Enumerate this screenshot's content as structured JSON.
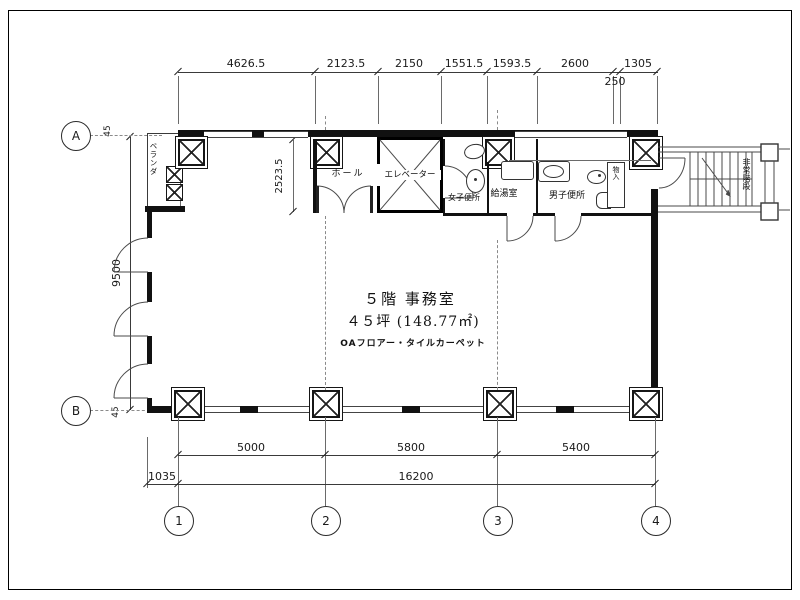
{
  "plan": {
    "office": {
      "title": "５階 事務室",
      "area": "４５坪 (148.77㎡)",
      "floor_spec": "OAフロアー・タイルカーペット"
    },
    "rooms": {
      "hall": "ホール",
      "elevator": "エレベーター",
      "womens_wc": "女子便所",
      "kitchen": "給湯室",
      "mens_wc": "男子便所",
      "storage": "物入",
      "veranda": "ベランダ",
      "stairs": "非常階段"
    }
  },
  "grid": {
    "a": "A",
    "b": "B",
    "c1": "1",
    "c2": "2",
    "c3": "3",
    "c4": "4"
  },
  "dims": {
    "top": [
      "4626.5",
      "2123.5",
      "2150",
      "1551.5",
      "1593.5",
      "2600",
      "1305"
    ],
    "top_sub": "250",
    "height": "9500",
    "hall_depth": "2523.5",
    "offset_a": "45",
    "offset_b": "45",
    "spans": [
      "5000",
      "5800",
      "5400"
    ],
    "total": "16200",
    "left_margin": "1035"
  }
}
